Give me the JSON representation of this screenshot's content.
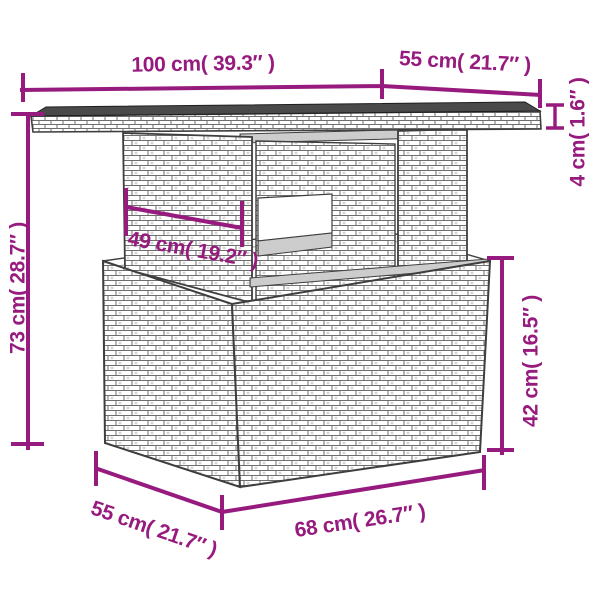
{
  "colors": {
    "dimension": "#971b7e",
    "outline": "#3e3e3e",
    "glass": "#4a4a4a"
  },
  "diagram": {
    "labels": {
      "top_width": "100 cm( 39.3″ )",
      "top_depth": "55 cm( 21.7″ )",
      "top_thickness": "4 cm( 1.6″ )",
      "total_height": "73 cm( 28.7″ )",
      "shelf_width": "49 cm( 19.2″ )",
      "base_height": "42 cm( 16.5″ )",
      "base_depth": "55 cm( 21.7″ )",
      "base_width": "68 cm( 26.7″ )"
    }
  }
}
